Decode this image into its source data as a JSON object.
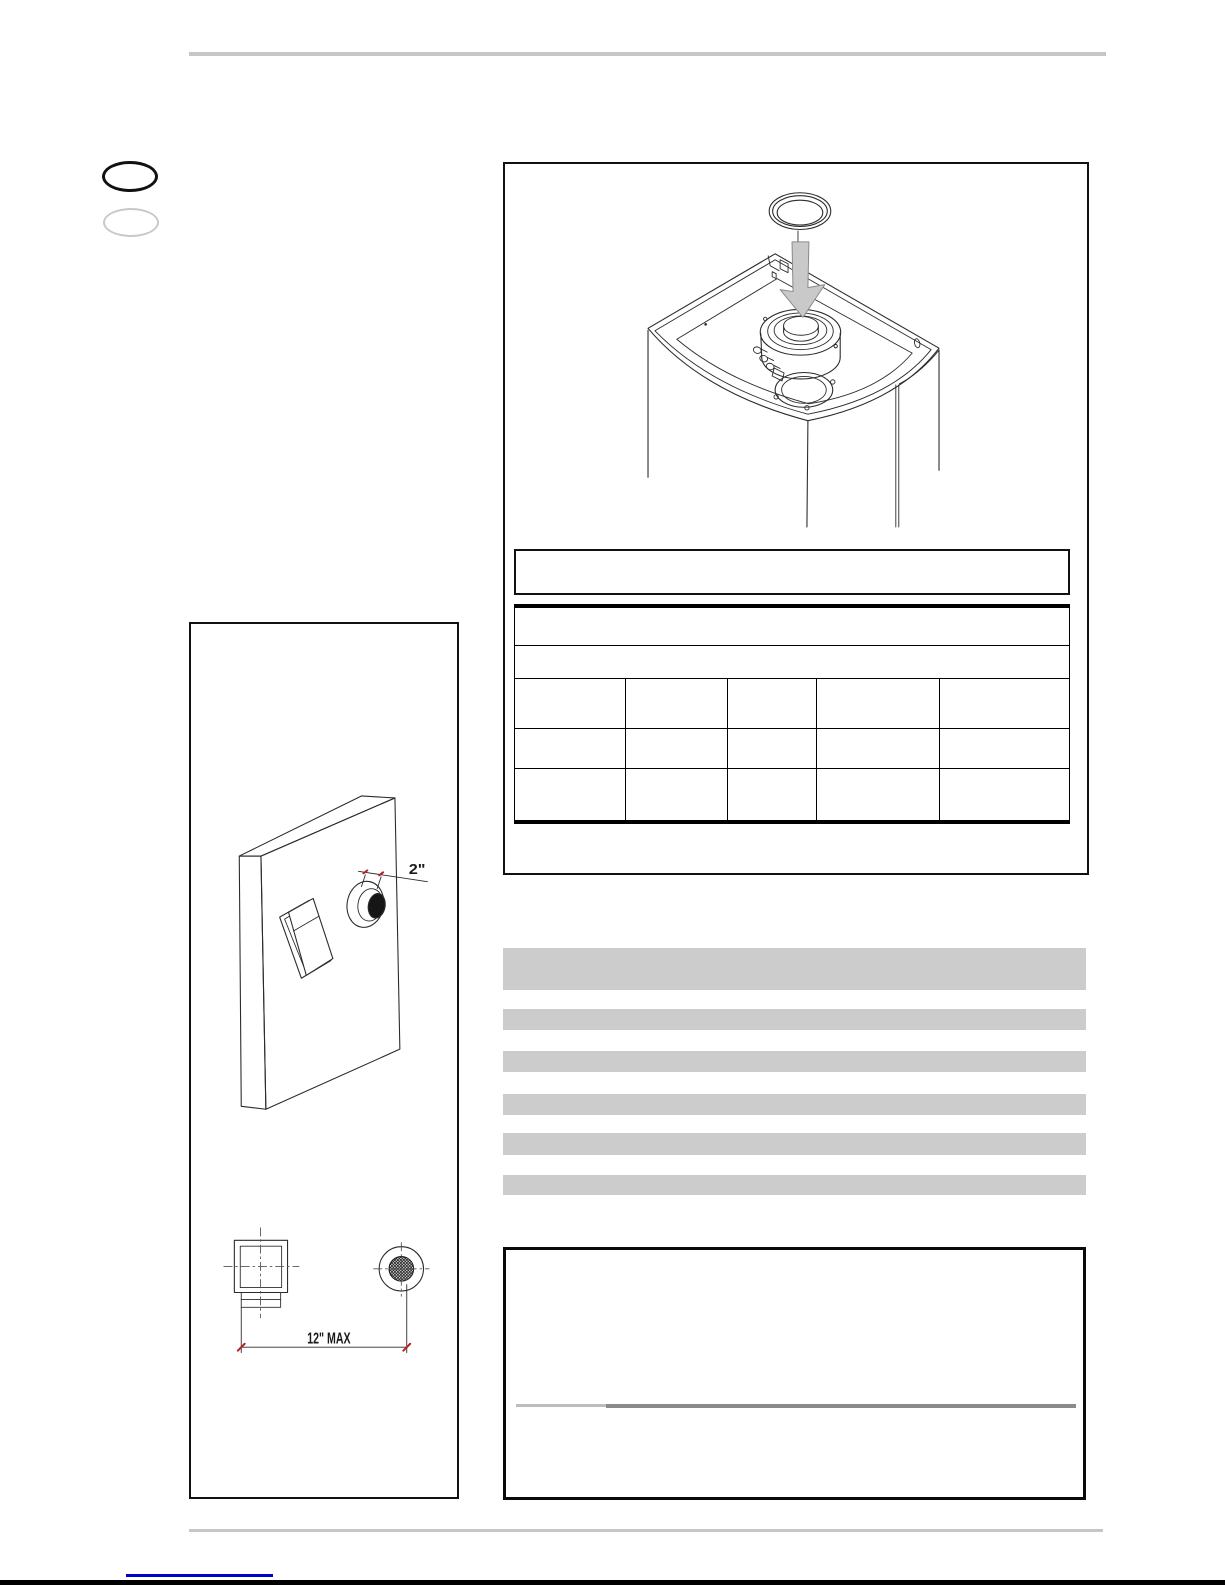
{
  "colors": {
    "page-bg": "#ffffff",
    "line-dark": "#2b2b2b",
    "rule-gray": "#c6c6c6",
    "bar-gray": "#cccccc",
    "arrow-gray": "#c9c9c9",
    "tick-red": "#b22222",
    "link-blue": "#0000cd",
    "divider-light": "#bdbdbd",
    "divider-dark": "#8a8a8a",
    "oval-active": "#111111",
    "oval-inactive": "#c9c9c9"
  },
  "flue_panel": {
    "caption": ""
  },
  "spec_table": {
    "title_row": "",
    "subtitle_row": "",
    "columns": [
      "",
      "",
      "",
      "",
      ""
    ],
    "rows": [
      [
        "",
        "",
        "",
        "",
        ""
      ],
      [
        "",
        "",
        "",
        "",
        ""
      ]
    ]
  },
  "wall_diagram": {
    "hole_offset_label": "2\"",
    "max_distance_label": "12\" MAX"
  },
  "highlighted_paragraph": {
    "line1": "",
    "line2": "",
    "line3": "",
    "line4": "",
    "line5": "",
    "line6": ""
  },
  "note_panel": {
    "text": ""
  }
}
